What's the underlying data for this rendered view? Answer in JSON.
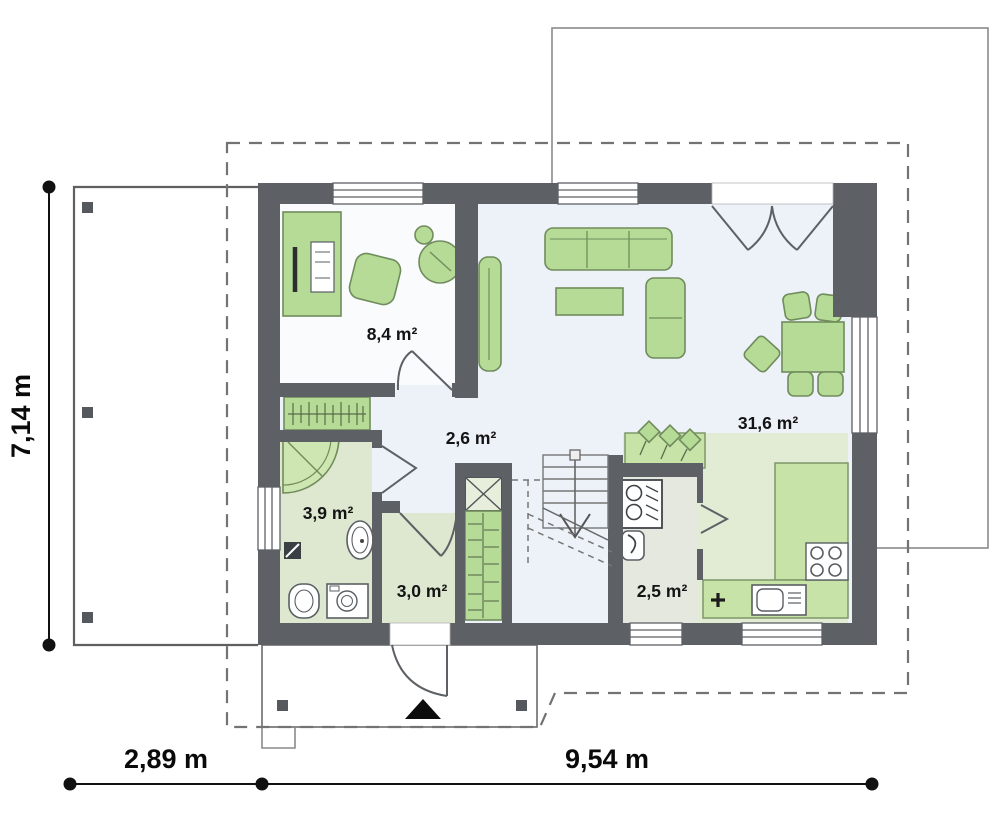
{
  "plan": {
    "type": "floor-plan",
    "rooms": [
      {
        "id": "office",
        "area": "8,4 m²"
      },
      {
        "id": "hall",
        "area": "2,6 m²"
      },
      {
        "id": "bathroom",
        "area": "3,9 m²"
      },
      {
        "id": "entry-hall",
        "area": "3,0 m²"
      },
      {
        "id": "kitchen",
        "area": "2,5 m²"
      },
      {
        "id": "living-room",
        "area": "31,6 m²"
      }
    ],
    "dimensions": {
      "side_height": "7,14 m",
      "carport_width": "2,89 m",
      "house_width": "9,54 m"
    },
    "colors": {
      "wall": "#5d6165",
      "floor_main": "#edf1f8",
      "floor_office": "#fafbfd",
      "floor_wet": "#dee8d0",
      "floor_kitchen": "#e2ebd4",
      "floor_pantry": "#e5e8df",
      "furniture": "#b5db97",
      "counter": "#c7e3a8",
      "boundary_dash": "#737373",
      "text": "#141414"
    }
  }
}
